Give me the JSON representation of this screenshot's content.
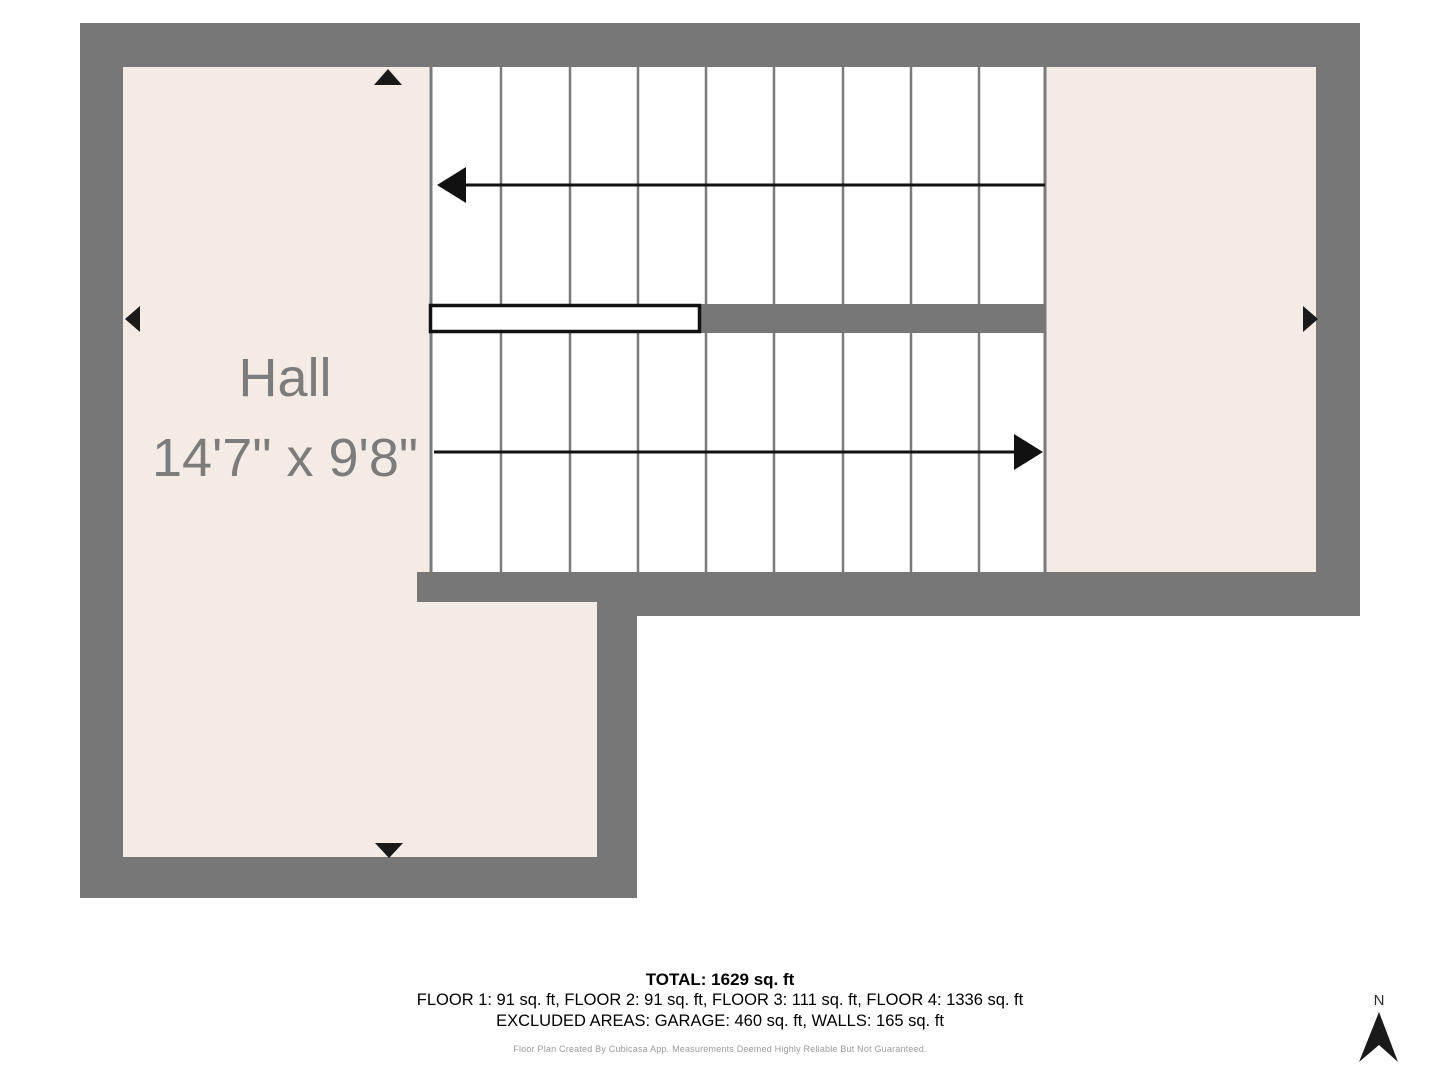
{
  "floor_plan": {
    "room": {
      "name": "Hall",
      "dimensions": "14'7\" x 9'8\""
    },
    "colors": {
      "wall": "#777777",
      "room_fill": "#f4ece4",
      "stair_fill": "#ffffff",
      "tread_line": "#7a7a7a",
      "label_text": "#7c7c7c",
      "arrow": "#111111"
    }
  },
  "summary": {
    "total": "TOTAL: 1629 sq. ft",
    "floors": "FLOOR 1: 91 sq. ft, FLOOR 2: 91 sq. ft, FLOOR 3: 111 sq. ft, FLOOR 4: 1336 sq. ft",
    "excluded": "EXCLUDED AREAS: GARAGE: 460 sq. ft, WALLS: 165 sq. ft",
    "disclaimer": "Floor Plan Created By Cubicasa App. Measurements Deemed Highly Reliable But Not Guaranteed."
  },
  "compass": {
    "label": "N"
  }
}
